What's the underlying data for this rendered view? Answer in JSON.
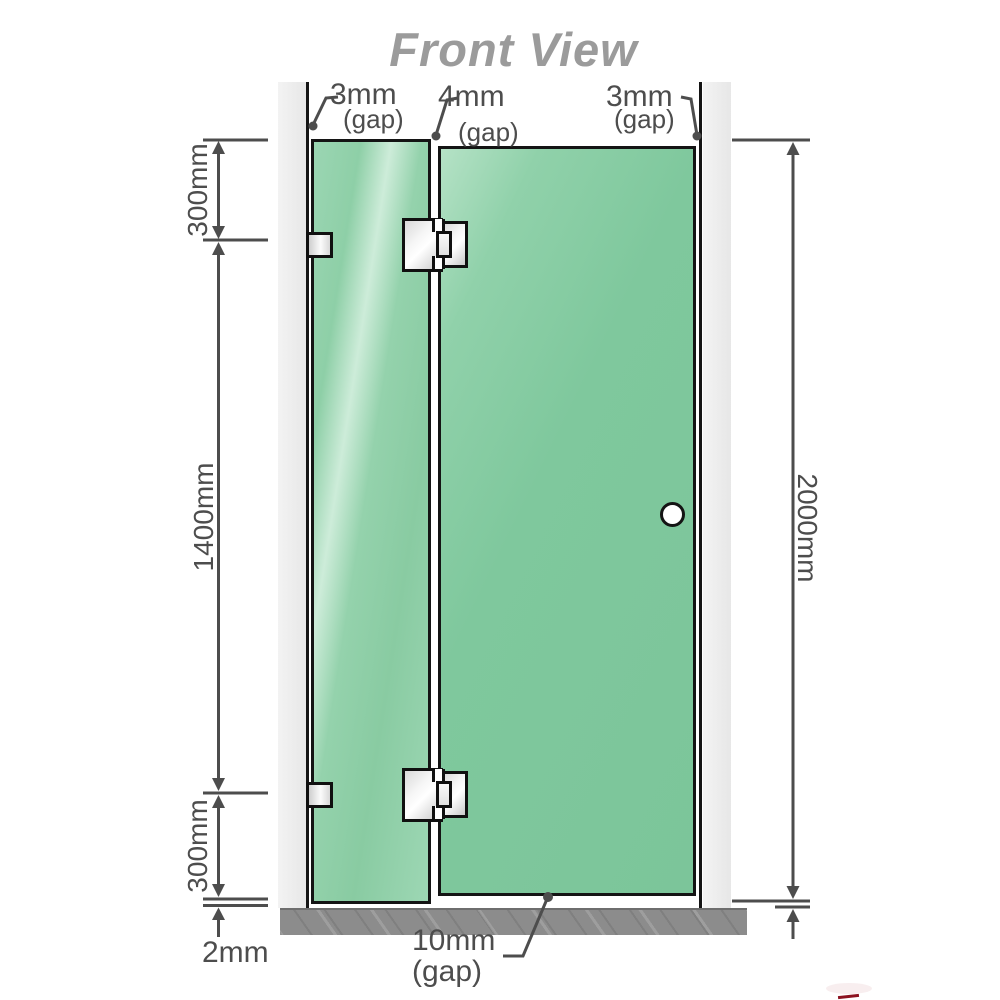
{
  "title": "Front View",
  "dimensions": {
    "top_left": {
      "value": "3mm",
      "qualifier": "(gap)"
    },
    "top_center": {
      "value": "4mm",
      "qualifier": "(gap)"
    },
    "top_right": {
      "value": "3mm",
      "qualifier": "(gap)"
    },
    "left_upper": {
      "value": "300mm"
    },
    "left_middle": {
      "value": "1400mm"
    },
    "left_lower": {
      "value": "300mm"
    },
    "bottom_left": {
      "value": "2mm"
    },
    "right": {
      "value": "2000mm"
    },
    "bottom_center": {
      "value": "10mm",
      "qualifier": "(gap)"
    }
  },
  "colors": {
    "glass_green": "#7ec79c",
    "glass_highlight": "#cdecd9",
    "wall_gray": "#ececec",
    "floor_gray": "#8c8c8c",
    "outline_black": "#141414",
    "dimension_gray": "#4d4d4d",
    "title_gray": "#9b9b9b",
    "logo_red": "#8c1220"
  }
}
